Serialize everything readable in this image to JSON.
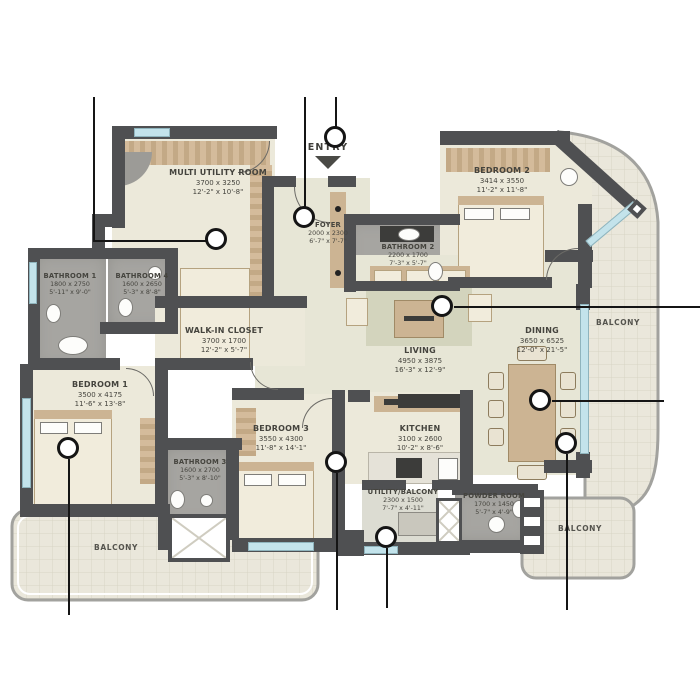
{
  "plan": {
    "title": "apartment-floor-plan",
    "entry_label": "ENTRY",
    "rooms": [
      {
        "name": "MULTI UTILITY ROOM",
        "mm": "3700 x 3250",
        "ft": "12'-2\" x 10'-8\""
      },
      {
        "name": "FOYER",
        "mm": "2000 x 2300",
        "ft": "6'-7\" x 7'-7\""
      },
      {
        "name": "BATHROOM 2",
        "mm": "2200 x 1700",
        "ft": "7'-3\" x 5'-7\""
      },
      {
        "name": "BEDROOM 2",
        "mm": "3414 x 3550",
        "ft": "11'-2\" x 11'-8\""
      },
      {
        "name": "BATHROOM 1",
        "mm": "1800 x 2750",
        "ft": "5'-11\" x 9'-0\""
      },
      {
        "name": "BATHROOM 4",
        "mm": "1600 x 2650",
        "ft": "5'-3\" x 8'-8\""
      },
      {
        "name": "WALK-IN CLOSET",
        "mm": "3700 x 1700",
        "ft": "12'-2\" x 5'-7\""
      },
      {
        "name": "BEDROOM 1",
        "mm": "3500 x 4175",
        "ft": "11'-6\" x 13'-8\""
      },
      {
        "name": "BATHROOM 3",
        "mm": "1600 x 2700",
        "ft": "5'-3\" x 8'-10\""
      },
      {
        "name": "BEDROOM 3",
        "mm": "3550 x 4300",
        "ft": "11'-8\" x 14'-1\""
      },
      {
        "name": "LIVING",
        "mm": "4950 x 3875",
        "ft": "16'-3\" x 12'-9\""
      },
      {
        "name": "KITCHEN",
        "mm": "3100 x 2600",
        "ft": "10'-2\" x 8'-6\""
      },
      {
        "name": "DINING",
        "mm": "3650 x 6525",
        "ft": "12'-0\" x 21'-5\""
      },
      {
        "name": "UTILITY/BALCONY",
        "mm": "2300 x 1500",
        "ft": "7'-7\" x 4'-11\""
      },
      {
        "name": "POWDER ROOM",
        "mm": "1700 x 1450",
        "ft": "5'-7\" x 4'-9\""
      }
    ],
    "balconies": [
      "BALCONY",
      "BALCONY",
      "BALCONY"
    ],
    "colors": {
      "wall": "#4f5052",
      "floor": "#ece9da",
      "bathroom": "#a6a5a1",
      "wood": "#ccb493",
      "window": "#c3e3eb",
      "balcony_tile": "#eae7db",
      "callout_line": "#151515",
      "text": "#45443e"
    }
  }
}
